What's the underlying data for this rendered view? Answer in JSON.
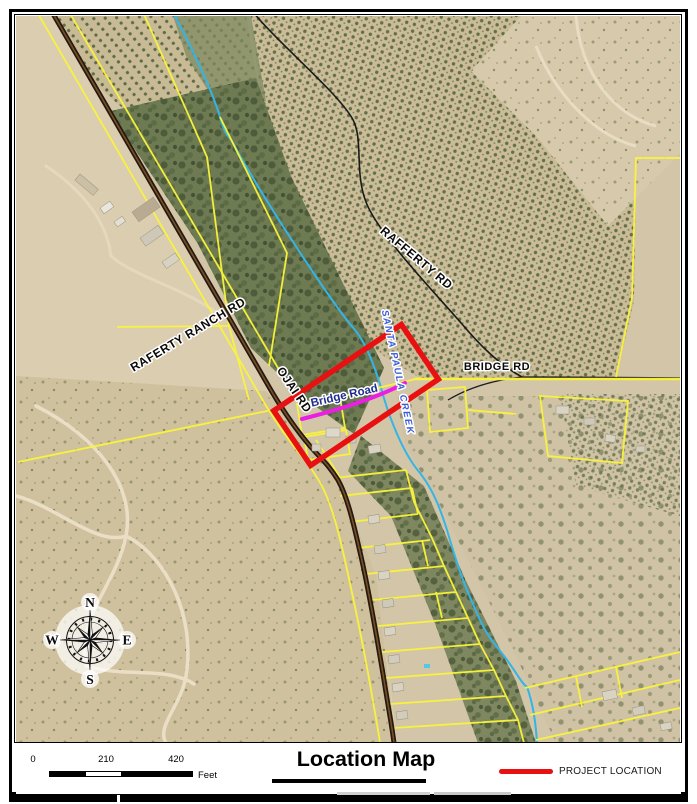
{
  "map": {
    "labels": {
      "raferty_ranch_rd": "RAFERTY RANCH  RD",
      "rafferty_rd": "RAFFERTY  RD",
      "ojai_rd": "OJAI  RD",
      "bridge_rd": "BRIDGE  RD",
      "bridge_road": "Bridge Road",
      "creek": "SANTA PAULA CREEK"
    },
    "compass": {
      "n": "N",
      "e": "E",
      "s": "S",
      "w": "W"
    },
    "colors": {
      "parcel_line": "#fbf53a",
      "creek_line": "#33b5e8",
      "project_outline": "#e81010",
      "bridge_segment": "#ea1fe3",
      "road_label": "#0a0a0a",
      "bridge_road_label": "#1f2b8f",
      "creek_label": "#3a5bd9"
    }
  },
  "footer": {
    "scale": {
      "ticks": [
        "0",
        "210",
        "420"
      ],
      "unit": "Feet"
    },
    "title": "Location Map",
    "legend": {
      "project_label": "PROJECT LOCATION",
      "color": "#e81010"
    }
  }
}
